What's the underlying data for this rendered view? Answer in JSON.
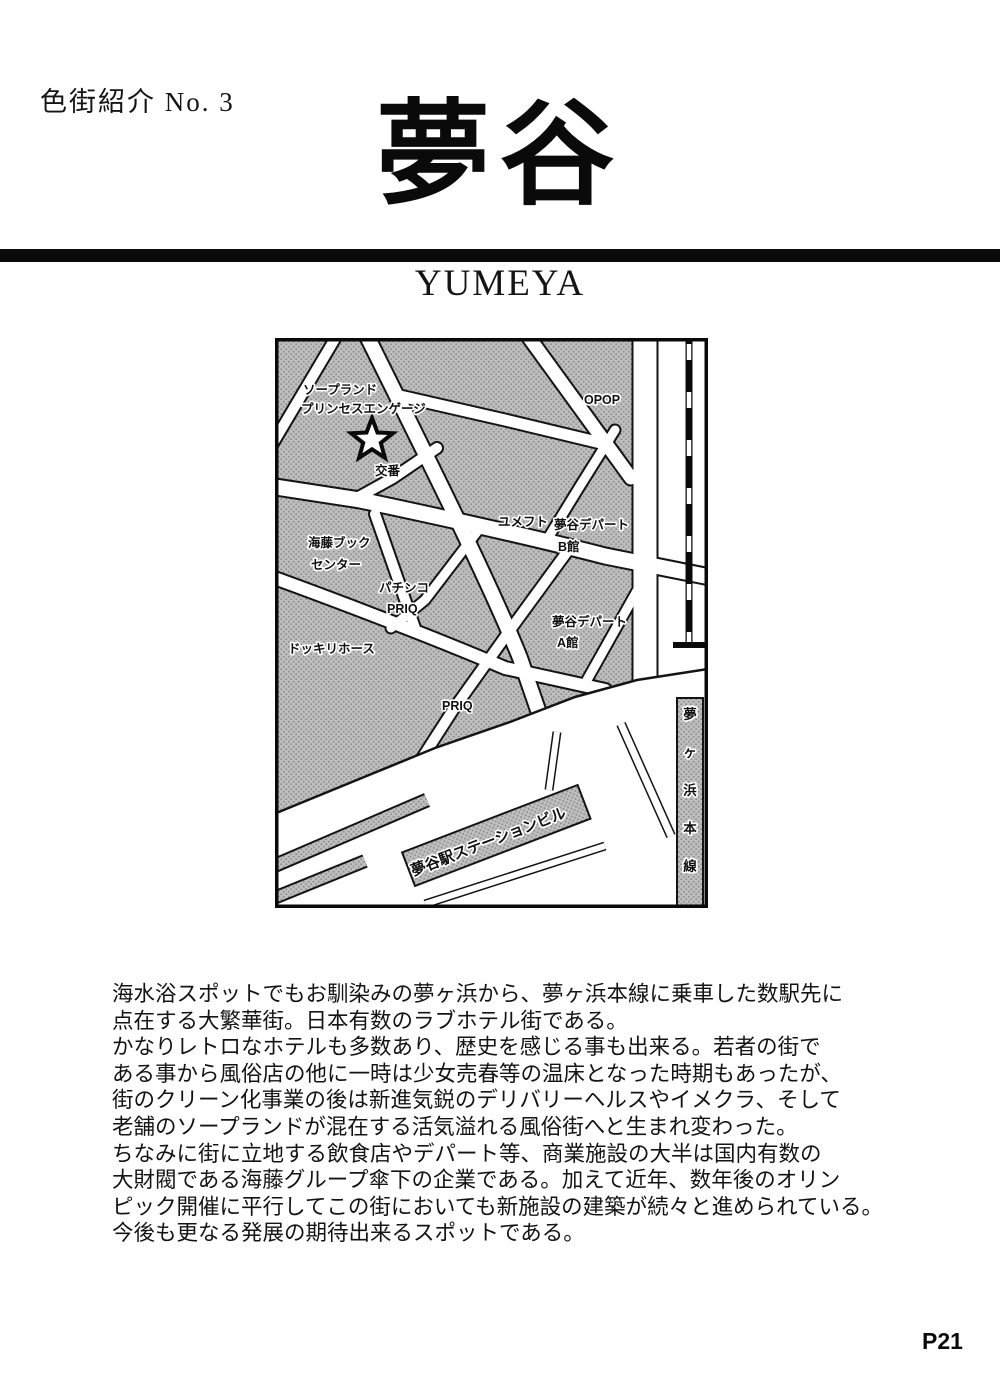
{
  "page": {
    "header_label": "色街紹介 No. 3",
    "title": "夢谷",
    "subtitle": "YUMEYA",
    "page_number": "P21",
    "background_color": "#ffffff",
    "ink_color": "#0a0a0a",
    "map_block_color": "#bdbdbd"
  },
  "map": {
    "marker": "star",
    "labels": [
      {
        "text": "ソープランド"
      },
      {
        "text": "プリンセスエンゲージ"
      },
      {
        "text": "交番"
      },
      {
        "text": "OPOP"
      },
      {
        "text": "ユメフト"
      },
      {
        "text": "夢谷デパート"
      },
      {
        "text": "B館"
      },
      {
        "text": "海藤ブック"
      },
      {
        "text": "センター"
      },
      {
        "text": "パチンコ"
      },
      {
        "text": "PRIQ"
      },
      {
        "text": "ドッキリホース"
      },
      {
        "text": "夢谷デパート"
      },
      {
        "text": "A館"
      },
      {
        "text": "PRIQ"
      },
      {
        "text": "夢谷駅ステーションビル"
      },
      {
        "text": "夢ヶ浜本線"
      }
    ]
  },
  "body": {
    "lines": [
      "海水浴スポットでもお馴染みの夢ヶ浜から、夢ヶ浜本線に乗車した数駅先に",
      "点在する大繁華街。日本有数のラブホテル街である。",
      "かなりレトロなホテルも多数あり、歴史を感じる事も出来る。若者の街で",
      "ある事から風俗店の他に一時は少女売春等の温床となった時期もあったが、",
      "街のクリーン化事業の後は新進気鋭のデリバリーヘルスやイメクラ、そして",
      "老舗のソープランドが混在する活気溢れる風俗街へと生まれ変わった。",
      "ちなみに街に立地する飲食店やデパート等、商業施設の大半は国内有数の",
      "大財閥である海藤グループ傘下の企業である。加えて近年、数年後のオリン",
      "ピック開催に平行してこの街においても新施設の建築が続々と進められている。",
      "今後も更なる発展の期待出来るスポットである。"
    ]
  }
}
